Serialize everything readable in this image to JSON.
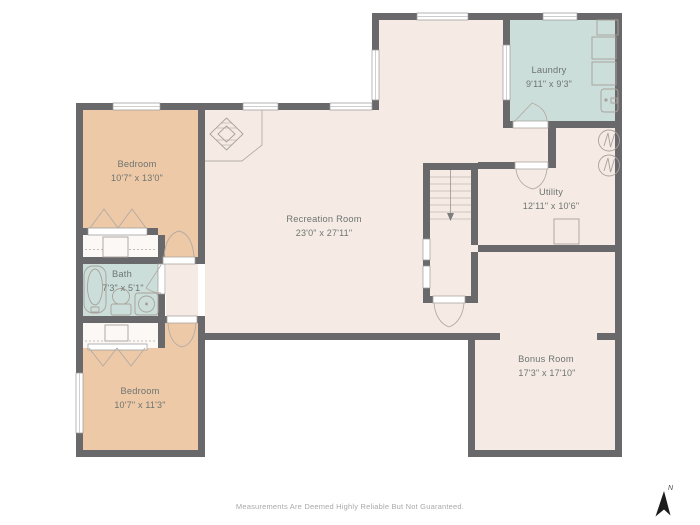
{
  "title": "Basement Floor Plan",
  "rooms": [
    {
      "id": "laundry",
      "name": "Laundry",
      "dims": "9'11\" x 9'3\""
    },
    {
      "id": "utility",
      "name": "Utility",
      "dims": "12'11\" x 10'6\""
    },
    {
      "id": "recreation",
      "name": "Recreation Room",
      "dims": "23'0\" x 27'11\""
    },
    {
      "id": "bedroom1",
      "name": "Bedroom",
      "dims": "10'7\" x 13'0\""
    },
    {
      "id": "bath",
      "name": "Bath",
      "dims": "7'3\" x 5'1\""
    },
    {
      "id": "bedroom2",
      "name": "Bedroom",
      "dims": "10'7\" x 11'3\""
    },
    {
      "id": "bonus",
      "name": "Bonus Room",
      "dims": "17'3\" x 17'10\""
    }
  ],
  "stairs": {
    "direction": "down"
  },
  "footer": {
    "disclaimer": "Measurements Are Deemed Highly Reliable But Not Guaranteed."
  },
  "compass": {
    "label": "N"
  },
  "colors": {
    "wall": "#69696b",
    "floor_cream": "#f5ebe4",
    "bedroom_tan": "#edc9a7",
    "wet_room_blue": "#cbdeda",
    "closet_white": "#fbf8f6",
    "fixture_line": "#a8a19b",
    "label_text": "#6e7471",
    "footer_text": "#a9a9a9"
  }
}
